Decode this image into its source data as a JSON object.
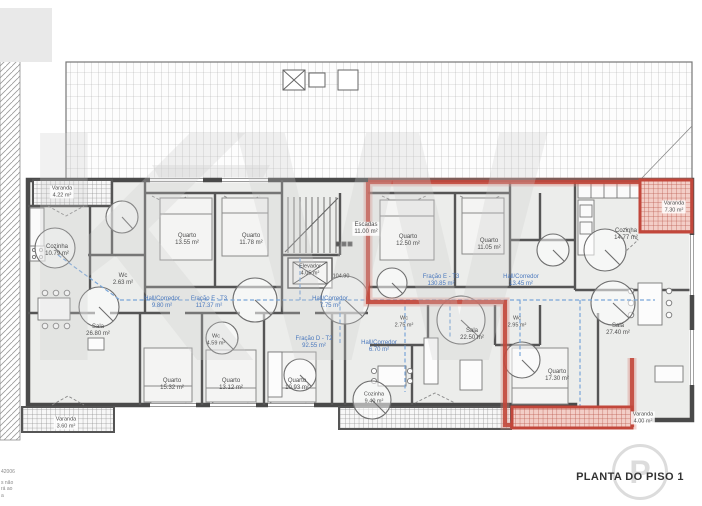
{
  "plan": {
    "title": "PLANTA DO PISO 1"
  },
  "watermark": {
    "text": "KW",
    "badge": "P"
  },
  "annotations": {
    "elevation": "104.90"
  },
  "disclaimer": [
    "42006",
    "s não",
    "rá ao",
    "a"
  ],
  "colors": {
    "red_highlight": "#c2473b",
    "blue_path": "#7aa6d8",
    "wall": "#4a4a4a",
    "floor": "#ecedeb"
  },
  "rooms": [
    {
      "name": "Varanda",
      "area": "4.22 m²"
    },
    {
      "name": "Cozinha",
      "area": "10.79 m²"
    },
    {
      "name": "Wc",
      "area": "2.63 m²"
    },
    {
      "name": "Quarto",
      "area": "13.55 m²"
    },
    {
      "name": "Quarto",
      "area": "11.78 m²"
    },
    {
      "name": "Escadas",
      "area": "11.00 m²"
    },
    {
      "name": "Elevador",
      "area": "4.05 m²"
    },
    {
      "name": "Hall/Corredor",
      "area": "9.80 m²"
    },
    {
      "name": "Fração F - T3",
      "area": "117.37 m²"
    },
    {
      "name": "Hall/Corredor",
      "area": "7.75 m²"
    },
    {
      "name": "Sala",
      "area": "26.80 m²"
    },
    {
      "name": "Wc",
      "area": "4.59 m²"
    },
    {
      "name": "Fração D - T2",
      "area": "92.55 m²"
    },
    {
      "name": "Hall/Corredor",
      "area": "6.70 m²"
    },
    {
      "name": "Quarto",
      "area": "15.32 m²"
    },
    {
      "name": "Quarto",
      "area": "13.12 m²"
    },
    {
      "name": "Quarto",
      "area": "10.93 m²"
    },
    {
      "name": "Cozinha",
      "area": "9.40 m²"
    },
    {
      "name": "Varanda",
      "area": "3.60 m²"
    },
    {
      "name": "Quarto",
      "area": "12.50 m²"
    },
    {
      "name": "Quarto",
      "area": "11.05 m²"
    },
    {
      "name": "Fração E - T3",
      "area": "130.85 m²"
    },
    {
      "name": "Hall/Corredor",
      "area": "13.45 m²"
    },
    {
      "name": "Wc",
      "area": "2.75 m²"
    },
    {
      "name": "Wc",
      "area": "2.95 m²"
    },
    {
      "name": "Sala",
      "area": "22.50 m²"
    },
    {
      "name": "Cozinha",
      "area": "14.77 m²"
    },
    {
      "name": "Varanda",
      "area": "7.30 m²"
    },
    {
      "name": "Sala",
      "area": "27.40 m²"
    },
    {
      "name": "Quarto",
      "area": "17.30 m²"
    },
    {
      "name": "Varanda",
      "area": "4.00 m²"
    }
  ]
}
